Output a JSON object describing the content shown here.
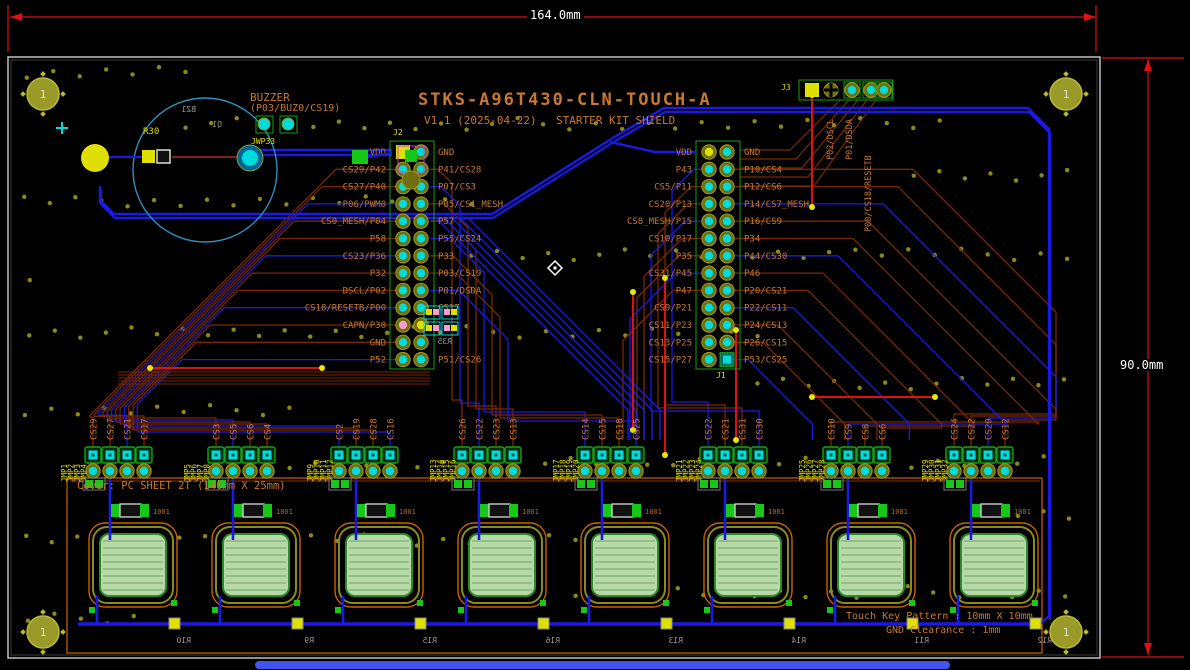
{
  "title": {
    "name": "STKS-A96T430-CLN-TOUCH-A",
    "version": "V1.1 (2025-04-22)",
    "subtitle": "STARTER KIT SHIELD"
  },
  "dimensions": {
    "width": "164.0mm",
    "height": "90.0mm"
  },
  "buzzer": {
    "label": "BUZZER",
    "pins_note": "(P03/BUZ0/CS19)",
    "r30": "R30",
    "bz1": "BZ1",
    "q1": "Q1",
    "jwp33": "JWP33"
  },
  "connectors": {
    "j2": {
      "ref": "J2",
      "left": [
        "VDD",
        "CS29/P42",
        "CS27/P40",
        "P06/PWM0",
        "CS0_MESH/P04",
        "P58",
        "CS23/P36",
        "P32",
        "DSCL/P02",
        "CS18/RESETB/P00",
        "CAPN/P30",
        "GND",
        "P52"
      ],
      "right": [
        "GND",
        "P41/CS28",
        "P07/CS3",
        "P05/CS1_MESH",
        "P57",
        "P55/CS24",
        "P33",
        "P03/CS19",
        "P01/DSDA",
        "CS17",
        "",
        "",
        "P51/CS26"
      ],
      "r35": "R35"
    },
    "j1": {
      "ref": "J1",
      "left": [
        "VDD",
        "P43",
        "CS5/P11",
        "CS20/P13",
        "CS8_MESH/P15",
        "CS10/P17",
        "P35",
        "CS31/P45",
        "P47",
        "CS9/P21",
        "CS11/P23",
        "CS13/P25",
        "CS15/P27"
      ],
      "right": [
        "GND",
        "P10/CS4",
        "P12/CS6",
        "P14/CS7_MESH",
        "P16/CS9",
        "P34",
        "P44/CS30",
        "P46",
        "P20/CS21",
        "P22/CS11",
        "P24/CS13",
        "P26/CS15",
        "P53/CS25"
      ]
    },
    "j3": {
      "ref": "J3",
      "labels": [
        "P02/DSCL",
        "P01/DSDA",
        "P00/CS18/RESETB"
      ]
    }
  },
  "jumper_groups": [
    {
      "jmp": [
        "JMP1",
        "JMP2",
        "JMP3",
        "JMP4"
      ],
      "cs": [
        "CS29",
        "CS27",
        "CS21",
        "CS17"
      ]
    },
    {
      "jmp": [
        "JMP5",
        "JMP6",
        "JMP7",
        "JMP8"
      ],
      "cs": [
        "CS3",
        "CS5",
        "CS6",
        "CS4"
      ]
    },
    {
      "jmp": [
        "JMP9",
        "JMP10",
        "JMP11",
        "JMP12"
      ],
      "cs": [
        "CS2",
        "CS19",
        "CS28",
        "CS16"
      ]
    },
    {
      "jmp": [
        "JMP13",
        "JMP14",
        "JMP15",
        "JMP16"
      ],
      "cs": [
        "CS26",
        "CS22",
        "CS23",
        "CS13"
      ]
    },
    {
      "jmp": [
        "JMP17",
        "JMP18",
        "JMP19",
        "JMP20"
      ],
      "cs": [
        "CS14",
        "CS15",
        "CS18",
        "CS25"
      ]
    },
    {
      "jmp": [
        "JMP21",
        "JMP22",
        "JMP23",
        "JMP24"
      ],
      "cs": [
        "CS22",
        "CS21",
        "CS31",
        "CS30"
      ]
    },
    {
      "jmp": [
        "JMP25",
        "JMP26",
        "JMP27",
        "JMP28"
      ],
      "cs": [
        "CS10",
        "CS9",
        "CS8",
        "CS6"
      ]
    },
    {
      "jmp": [
        "JMP29",
        "JMP30",
        "JMP31",
        "JMP32"
      ],
      "cs": [
        "CS24",
        "CS22",
        "CS20",
        "CS12"
      ]
    }
  ],
  "bottom_refs": [
    "R10",
    "R9",
    "R15",
    "R16",
    "R13",
    "R14",
    "R11",
    "R12"
  ],
  "resistor_value": "1001",
  "notes": {
    "cover": "Cover: PC SHEET 2T (140mm X 25mm)",
    "touch_key": "Touch Key Pattern : 10mm X 10mm",
    "gnd_clearance": "GND Clearance : 1mm"
  },
  "mounting_hole_label": "1",
  "colors": {
    "top_copper": "#7b2800",
    "bottom_copper": "#1a1ae6",
    "silk_orange": "#c87830",
    "silk_yellow": "#e0e000",
    "pad_cyan": "#00dcdc",
    "dimension_red": "#dd1111",
    "via_olive": "#8a8a18",
    "board_outline": "#c0c0c0",
    "pad_green": "#18c818",
    "touch_pad_fill": "#b7d9a6"
  }
}
